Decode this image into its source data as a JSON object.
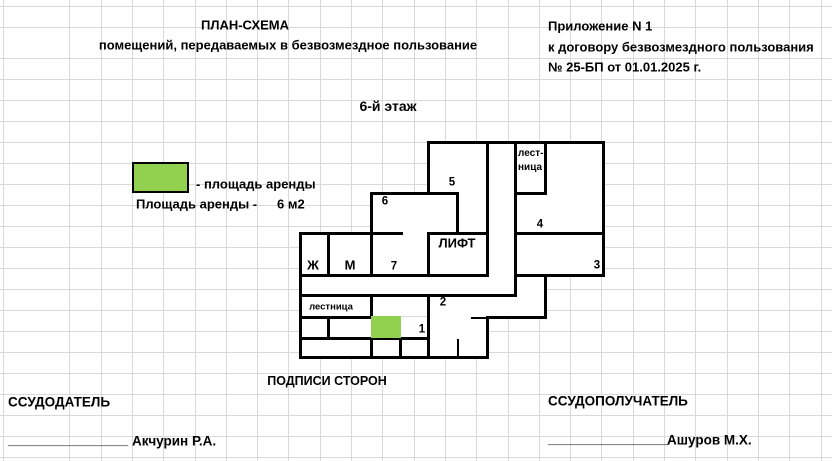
{
  "document": {
    "title_line1": "ПЛАН-СХЕМА",
    "title_line2": "помещений, передаваемых в безвозмездное пользование",
    "annex": {
      "line1": "Приложение N 1",
      "line2": "к договору безвозмездного пользования",
      "line3": "№ 25-БП от 01.01.2025 г."
    },
    "floor_title": "6-й этаж"
  },
  "legend": {
    "swatch_color": "#92d050",
    "swatch_label": "- площадь аренды",
    "area_label": "Площадь аренды -",
    "area_value": "6 м2"
  },
  "plan": {
    "highlight_color": "#92d050",
    "rooms": {
      "r1": "1",
      "r2": "2",
      "r3": "3",
      "r4": "4",
      "r5": "5",
      "r6": "6",
      "r7": "7",
      "lift": "ЛИФТ",
      "wc_women": "Ж",
      "wc_men": "М",
      "stairs_top_line1": "лест-",
      "stairs_top_line2": "ница",
      "stairs_bottom": "лестница"
    }
  },
  "signatures": {
    "heading": "ПОДПИСИ СТОРОН",
    "lender_label": "ССУДОДАТЕЛЬ",
    "borrower_label": "ССУДОПОЛУЧАТЕЛЬ",
    "signature_line": "________________",
    "lender_name": "Акчурин Р.А.",
    "borrower_name": "Ашуров М.Х."
  }
}
